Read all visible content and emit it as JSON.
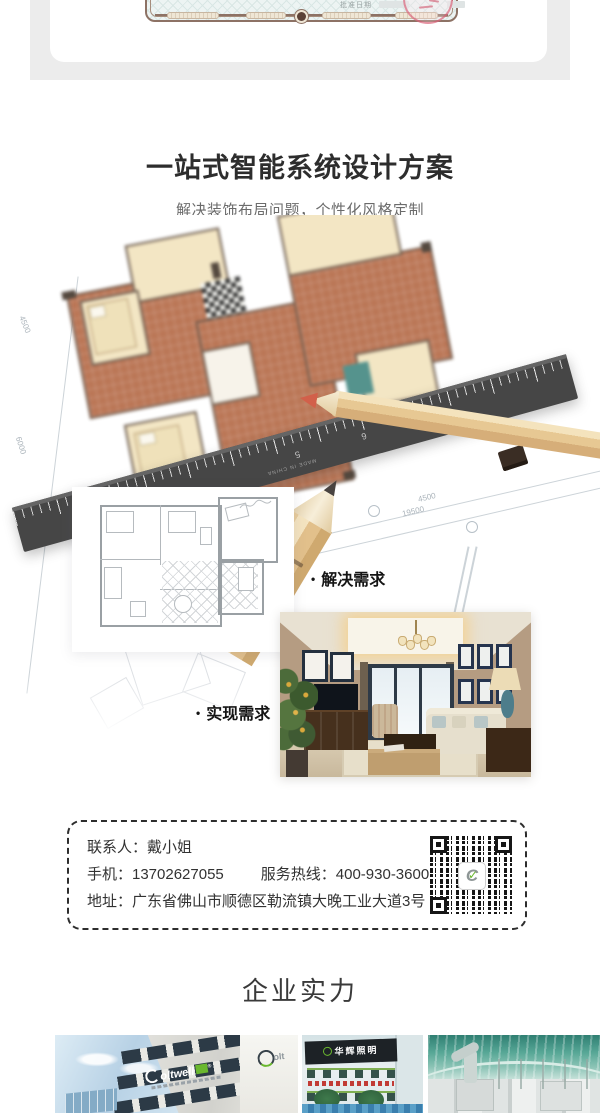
{
  "cert": {
    "approval_label": "批准日期"
  },
  "design": {
    "title": "一站式智能系统设计方案",
    "subtitle": "解决装饰布局问题，个性化风格定制",
    "bullet": "•",
    "solve_label": "解决需求",
    "realize_label": "实现需求"
  },
  "blueprint": {
    "dims": [
      "5100",
      "19500",
      "4500",
      "4500",
      "6000"
    ],
    "ruler_numbers": [
      "7",
      "6",
      "5"
    ],
    "ruler_made_in": "MADE IN CHINA"
  },
  "contact": {
    "person": "联系人：戴小姐",
    "phone": "手机：13702627055",
    "hotline": "服务热线：400-930-3600",
    "address": "地址：广东省佛山市顺德区勒流镇大晚工业大道3号"
  },
  "qr": {
    "logo_letter": "C",
    "logo_check": "✓"
  },
  "strength": {
    "title": "企业实力"
  },
  "gallery": {
    "brand": "oltwell",
    "brand_reg": "®",
    "fascia_brand": "olt",
    "sign2": "华辉照明"
  },
  "colors": {
    "accent_green": "#6ab82e",
    "stamp_red": "#d6556e",
    "gray_band": "#ececec",
    "cert_border": "#8d7265",
    "terracotta": "#b97251",
    "ruler_dark": "#464646"
  }
}
